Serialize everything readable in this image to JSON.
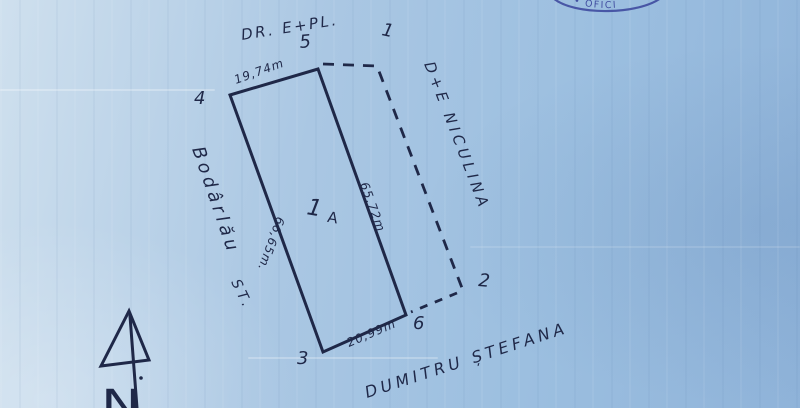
{
  "colors": {
    "paper-light": "#cfe0ee",
    "paper-mid": "#aac7e3",
    "paper-deep": "#8fb3d9",
    "ink": "#1f2848",
    "stamp-ink": "#39449b"
  },
  "sketch": {
    "road_label": "DR. E+PL.",
    "parcel_number": "1",
    "parcel_letter": "A",
    "points": {
      "p1": "1",
      "p2": "2",
      "p3": "3",
      "p4": "4",
      "p5": "5",
      "p6": "6"
    },
    "dimensions": {
      "top": "19,74m",
      "left": "66,65m.",
      "right": "65,72m",
      "bottom": "20,99m"
    },
    "neighbors": {
      "left_name": "Bodârlău",
      "left_abbr": "ST.",
      "right_name": "D+E NICULINA",
      "bottom_name": "DUMITRU ȘTEFANA"
    },
    "compass": {
      "north_letter": "N"
    },
    "stamp": {
      "arc_text": "• • OFICI"
    }
  }
}
